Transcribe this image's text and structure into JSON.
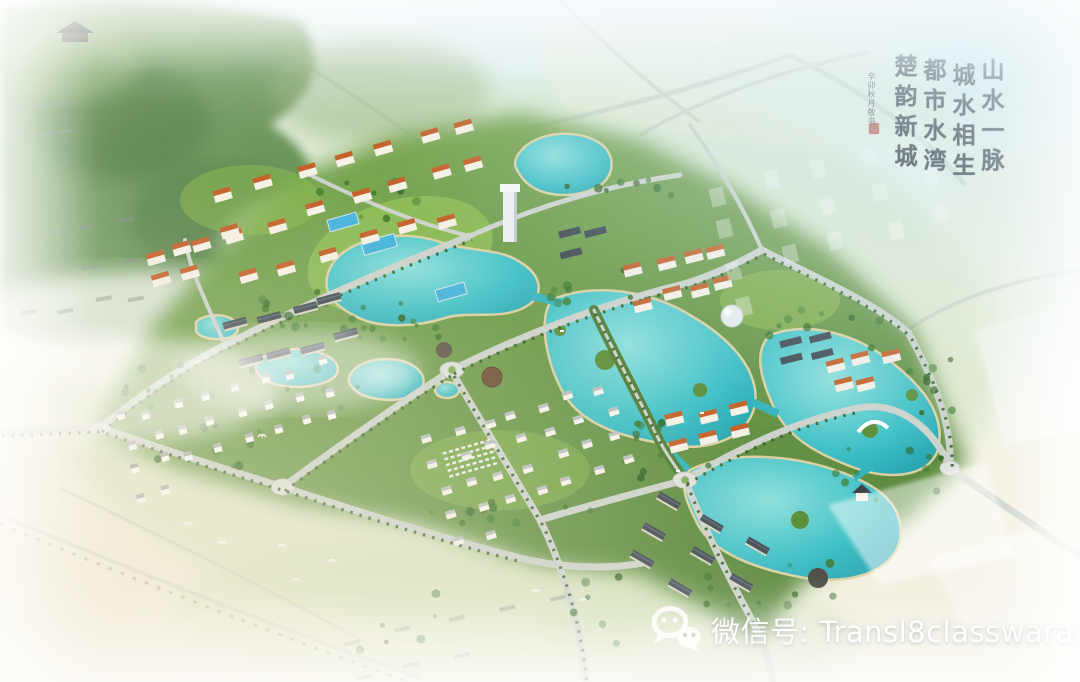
{
  "overlay": {
    "calligraphy": {
      "phrases": [
        "山水一脉",
        "城水相生",
        "都市水湾",
        "楚韵新城"
      ],
      "signature": "辛卯秋月敬书",
      "ink_color": "#232a30",
      "seal_color": "#b23a2c"
    },
    "watermark": {
      "icon": "wechat-icon",
      "text": "微信号: Transl8classwaraid",
      "text_color": "#ffffff"
    }
  },
  "scene": {
    "kind": "aerial-masterplan-rendering",
    "palette": {
      "sky": "#d8ebef",
      "field": "#eef0da",
      "ground_haze": "#f1ecd9",
      "lawn": "#97c45a",
      "green_base": "#6d9c47",
      "tree": "#2f6323",
      "tree_light": "#3c7a2e",
      "water": "#3fc0c6",
      "water_deep": "#1f9aa8",
      "water_light": "#8fe0dc",
      "shore_sand": "#dbd2a4",
      "road": "#cdd3cc",
      "roof_orange": "#c4622b",
      "roof_dark": "#414b54",
      "building_white": "#f5f1e6",
      "pool_blue": "#46b4dc",
      "mist": "#ffffff"
    }
  }
}
